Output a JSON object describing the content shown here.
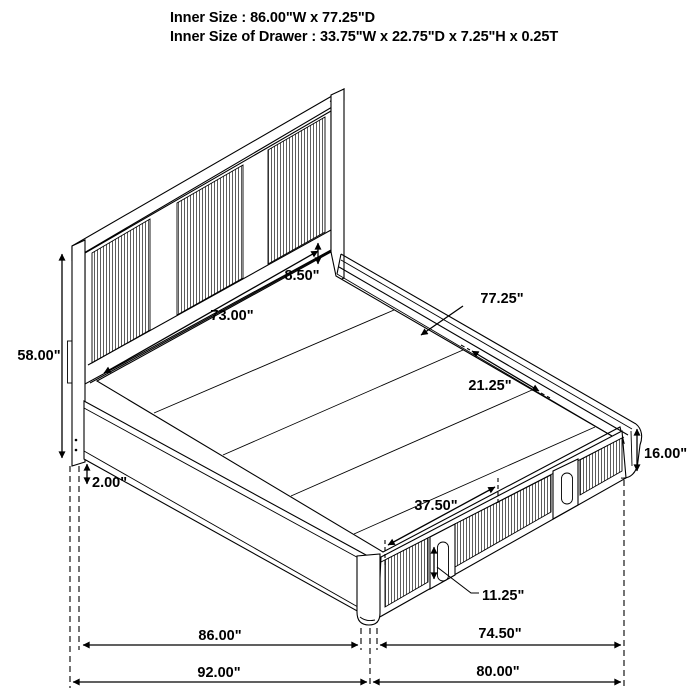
{
  "page": {
    "background": "#ffffff",
    "line_color": "#000000"
  },
  "header": {
    "line1": "Inner Size : 86.00\"W x 77.25\"D",
    "line2": "Inner Size of Drawer : 33.75\"W x 22.75\"D x 7.25\"H x 0.25T"
  },
  "diagram": {
    "subject": "isometric-line-drawing-of-storage-platform-bed",
    "labels": {
      "headboard_width": "73.00\"",
      "headboard_rail": "8.50\"",
      "headboard_height": "58.00\"",
      "base_gap": "2.00\"",
      "depth": "77.25\"",
      "drawer_depth": "21.25\"",
      "rail_height": "16.00\"",
      "drawer_span": "37.50\"",
      "handle_height": "11.25\"",
      "inner_width": "86.00\"",
      "foot_inner": "74.50\"",
      "overall_width": "92.00\"",
      "foot_overall": "80.00\""
    }
  }
}
